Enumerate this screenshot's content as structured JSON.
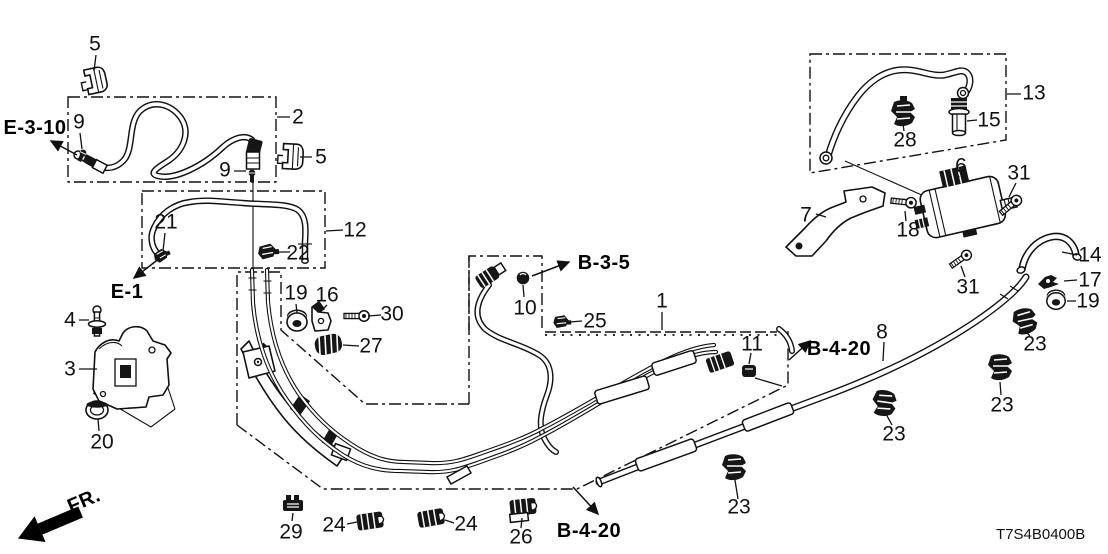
{
  "diagram": {
    "code": "T7S4B0400B",
    "background": "#ffffff",
    "line_color": "#111111",
    "description_labels": "fuel-pipe-parts-diagram"
  },
  "callouts": [
    {
      "text": "5",
      "x": 95,
      "y": 44
    },
    {
      "text": "2",
      "x": 298,
      "y": 117
    },
    {
      "text": "9",
      "x": 79,
      "y": 122
    },
    {
      "text": "5",
      "x": 321,
      "y": 157
    },
    {
      "text": "9",
      "x": 225,
      "y": 170
    },
    {
      "text": "12",
      "x": 355,
      "y": 230
    },
    {
      "text": "21",
      "x": 166,
      "y": 222
    },
    {
      "text": "22",
      "x": 298,
      "y": 253
    },
    {
      "text": "4",
      "x": 70,
      "y": 320
    },
    {
      "text": "3",
      "x": 70,
      "y": 369
    },
    {
      "text": "20",
      "x": 102,
      "y": 442
    },
    {
      "text": "19",
      "x": 296,
      "y": 293
    },
    {
      "text": "16",
      "x": 327,
      "y": 295
    },
    {
      "text": "30",
      "x": 392,
      "y": 314
    },
    {
      "text": "27",
      "x": 371,
      "y": 346
    },
    {
      "text": "10",
      "x": 525,
      "y": 308
    },
    {
      "text": "25",
      "x": 595,
      "y": 321
    },
    {
      "text": "1",
      "x": 662,
      "y": 301
    },
    {
      "text": "11",
      "x": 752,
      "y": 344
    },
    {
      "text": "8",
      "x": 882,
      "y": 332
    },
    {
      "text": "29",
      "x": 291,
      "y": 532
    },
    {
      "text": "24",
      "x": 334,
      "y": 525
    },
    {
      "text": "24",
      "x": 466,
      "y": 524
    },
    {
      "text": "26",
      "x": 521,
      "y": 537
    },
    {
      "text": "13",
      "x": 1034,
      "y": 93
    },
    {
      "text": "28",
      "x": 905,
      "y": 140
    },
    {
      "text": "15",
      "x": 989,
      "y": 120
    },
    {
      "text": "6",
      "x": 961,
      "y": 166
    },
    {
      "text": "31",
      "x": 1019,
      "y": 173
    },
    {
      "text": "7",
      "x": 806,
      "y": 215
    },
    {
      "text": "18",
      "x": 908,
      "y": 230
    },
    {
      "text": "31",
      "x": 968,
      "y": 287
    },
    {
      "text": "14",
      "x": 1090,
      "y": 255
    },
    {
      "text": "17",
      "x": 1090,
      "y": 280
    },
    {
      "text": "19",
      "x": 1088,
      "y": 301
    },
    {
      "text": "23",
      "x": 1035,
      "y": 344
    },
    {
      "text": "23",
      "x": 1002,
      "y": 405
    },
    {
      "text": "23",
      "x": 894,
      "y": 434
    },
    {
      "text": "23",
      "x": 739,
      "y": 507
    }
  ],
  "ref_labels": [
    {
      "text": "E-3-10",
      "x": 35,
      "y": 128,
      "rotate": 0
    },
    {
      "text": "E-1",
      "x": 127,
      "y": 292,
      "rotate": 0
    },
    {
      "text": "B-3-5",
      "x": 604,
      "y": 263,
      "rotate": 0
    },
    {
      "text": "B-4-20",
      "x": 839,
      "y": 349,
      "rotate": 0
    },
    {
      "text": "B-4-20",
      "x": 589,
      "y": 531,
      "rotate": 0
    },
    {
      "text": "FR.",
      "x": 84,
      "y": 501,
      "rotate": -23
    }
  ]
}
